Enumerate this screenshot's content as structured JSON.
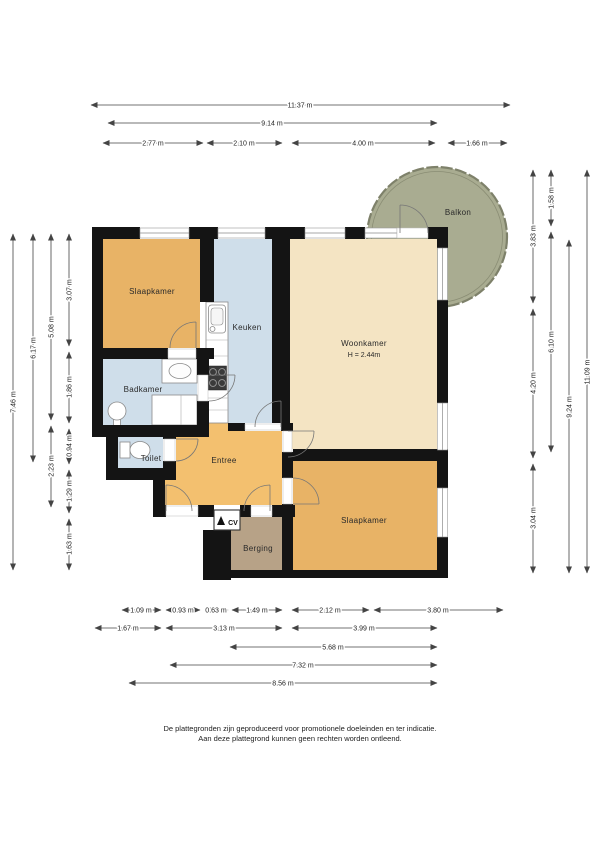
{
  "rooms": {
    "slaapkamer_1": "Slaapkamer",
    "keuken": "Keuken",
    "woonkamer": "Woonkamer",
    "woonkamer_height": "H = 2.44m",
    "badkamer": "Badkamer",
    "toilet": "Toilet",
    "entree": "Entree",
    "berging": "Berging",
    "balkon": "Balkon",
    "slaapkamer_2": "Slaapkamer",
    "cv": "CV"
  },
  "dims": {
    "top": [
      "11.37 m",
      "9.14 m",
      "2.77 m",
      "2.10 m",
      "4.00 m",
      "1.66 m"
    ],
    "left": [
      "7.46 m",
      "6.17 m",
      "5.08 m",
      "2.23 m",
      "3.07 m",
      "1.86 m",
      "0.94 m",
      "1.29 m",
      "1.63 m"
    ],
    "right": [
      "3.83 m",
      "4.20 m",
      "3.04 m",
      "1.58 m",
      "6.10 m",
      "9.24 m",
      "11.09 m"
    ],
    "bottom": [
      "1.09 m",
      "0.93 m",
      "0.63 m",
      "1.49 m",
      "2.12 m",
      "3.80 m",
      "1.67 m",
      "3.13 m",
      "3.99 m",
      "5.68 m",
      "7.32 m",
      "8.56 m"
    ]
  },
  "footer": {
    "line1": "De plattegronden zijn geproduceerd voor promotionele doeleinden en ter indicatie.",
    "line2": "Aan deze plattegrond kunnen geen rechten worden ontleend."
  },
  "colors": {
    "bedroom": "#e8b366",
    "livingroom": "#f4e4c3",
    "kitchen_bath": "#cfdeea",
    "hall": "#f3c06f",
    "storage": "#b7a287",
    "balcony": "#a9ac91",
    "wall": "#141414"
  }
}
